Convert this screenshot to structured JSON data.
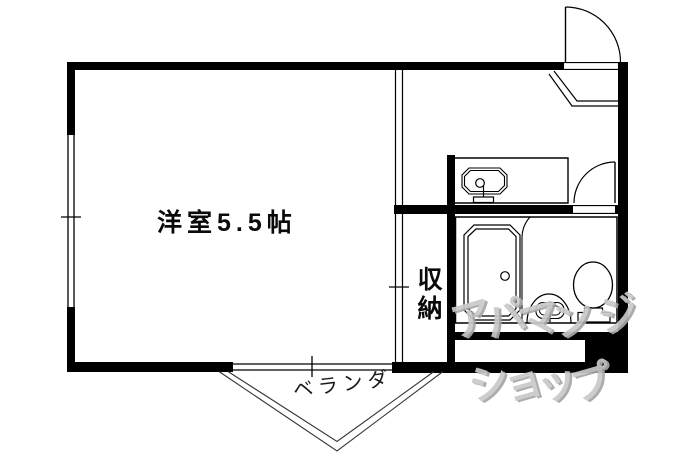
{
  "plan": {
    "room": {
      "label": "洋室5.5帖"
    },
    "closet": {
      "label": "収納"
    },
    "veranda": {
      "label": "ベランダ"
    },
    "watermark": {
      "line1": "アパマン",
      "line2": "ショップ",
      "fragment": "ジ",
      "color": "#c9c9c9"
    },
    "line_color": "#000000",
    "fixture_icons": [
      "entrance-door-icon",
      "entrance-step-icon",
      "washbasin-counter-icon",
      "washbasin-sink-icon",
      "faucet-icon",
      "bathroom-door-icon",
      "bathtub-icon",
      "bathroom-basin-icon",
      "toilet-icon",
      "window-icon",
      "veranda-outline-icon"
    ]
  }
}
